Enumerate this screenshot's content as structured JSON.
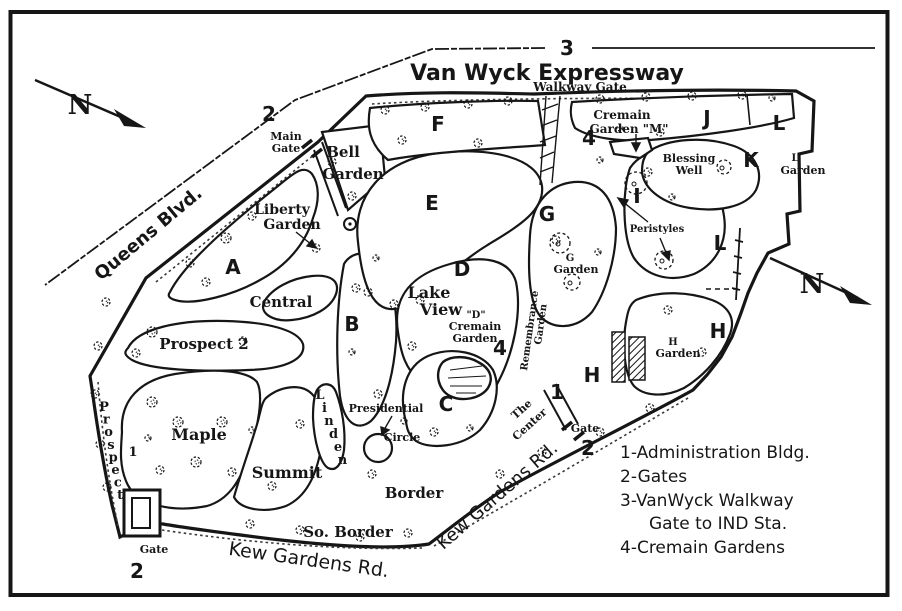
{
  "canvas": {
    "ink": "#161616",
    "bg": "#ffffff"
  },
  "map": {
    "labels": [
      {
        "id": "road-van-wyck-label",
        "t": "Van Wyck Expressway",
        "x": 547,
        "y": 80,
        "s": 22,
        "f": "sa",
        "w": 700
      },
      {
        "id": "marker-3-van-wyck",
        "t": "3",
        "x": 567,
        "y": 55,
        "s": 20,
        "f": "sa",
        "w": 700
      },
      {
        "id": "walkway-gate-label",
        "t": "Walkway Gate",
        "x": 580,
        "y": 91,
        "s": 12,
        "f": "se",
        "w": 700
      },
      {
        "id": "road-queens-blvd-label",
        "t": "Queens Blvd.",
        "x": 152,
        "y": 238,
        "s": 18,
        "f": "sa",
        "w": 700,
        "r": -40
      },
      {
        "id": "compass-n-top-label",
        "t": "N",
        "x": 80,
        "y": 114,
        "s": 27,
        "f": "se",
        "w": 700
      },
      {
        "id": "compass-n-right-label",
        "t": "N",
        "x": 812,
        "y": 293,
        "s": 27,
        "f": "se",
        "w": 700
      },
      {
        "id": "marker-2-main-gate",
        "t": "2",
        "x": 269,
        "y": 121,
        "s": 20,
        "f": "sa",
        "w": 700
      },
      {
        "id": "main-gate-label-line1",
        "t": "Main",
        "x": 286,
        "y": 140,
        "s": 11,
        "f": "se",
        "w": 700
      },
      {
        "id": "main-gate-label-line2",
        "t": "Gate",
        "x": 286,
        "y": 152,
        "s": 11,
        "f": "se",
        "w": 700
      },
      {
        "id": "bell-garden-label-line1",
        "t": "Bell",
        "x": 343,
        "y": 157,
        "s": 15,
        "f": "se",
        "w": 700
      },
      {
        "id": "bell-garden-label-line2",
        "t": "Garden",
        "x": 353,
        "y": 179,
        "s": 15,
        "f": "se",
        "w": 700
      },
      {
        "id": "liberty-garden-label-line1",
        "t": "Liberty",
        "x": 282,
        "y": 214,
        "s": 14,
        "f": "se",
        "w": 700
      },
      {
        "id": "liberty-garden-label-line2",
        "t": "Garden",
        "x": 292,
        "y": 229,
        "s": 14,
        "f": "se",
        "w": 700
      },
      {
        "id": "section-a-label",
        "t": "A",
        "x": 233,
        "y": 274,
        "s": 20,
        "f": "sa",
        "w": 700
      },
      {
        "id": "central-label",
        "t": "Central",
        "x": 281,
        "y": 307,
        "s": 15,
        "f": "se",
        "w": 700
      },
      {
        "id": "prospect-2-label",
        "t": "Prospect 2",
        "x": 204,
        "y": 349,
        "s": 15,
        "f": "se",
        "w": 700
      },
      {
        "id": "section-b-label",
        "t": "B",
        "x": 352,
        "y": 331,
        "s": 20,
        "f": "sa",
        "w": 700
      },
      {
        "id": "maple-label",
        "t": "Maple",
        "x": 199,
        "y": 440,
        "s": 16,
        "f": "se",
        "w": 700
      },
      {
        "id": "summit-label",
        "t": "Summit",
        "x": 287,
        "y": 478,
        "s": 16,
        "f": "se",
        "w": 700
      },
      {
        "id": "prospect-1-label",
        "t": "Prospect",
        "type": "v",
        "x": 104,
        "y": 411,
        "dx": 2.3,
        "dy": 12.6,
        "s": 13,
        "f": "se",
        "w": 700
      },
      {
        "id": "marker-1-prospect",
        "t": "1",
        "x": 133,
        "y": 456,
        "s": 13,
        "f": "se",
        "w": 700
      },
      {
        "id": "linden-label",
        "t": "Linden",
        "type": "v",
        "x": 320,
        "y": 399,
        "dx": 4.5,
        "dy": 13,
        "s": 13,
        "f": "se",
        "w": 700
      },
      {
        "id": "presidential-label-line1",
        "t": "Presidential",
        "x": 386,
        "y": 412,
        "s": 11,
        "f": "se",
        "w": 700
      },
      {
        "id": "presidential-label-line2",
        "t": "Circle",
        "x": 402,
        "y": 441,
        "s": 11,
        "f": "se",
        "w": 700
      },
      {
        "id": "border-label",
        "t": "Border",
        "x": 414,
        "y": 498,
        "s": 15,
        "f": "se",
        "w": 700
      },
      {
        "id": "so-border-label",
        "t": "So. Border",
        "x": 348,
        "y": 537,
        "s": 15,
        "f": "se",
        "w": 700
      },
      {
        "id": "road-kew-gardens-south-label",
        "t": "Kew Gardens Rd.",
        "x": 308,
        "y": 566,
        "s": 19,
        "f": "sa",
        "w": 400,
        "r": 8
      },
      {
        "id": "gate-sw-label",
        "t": "Gate",
        "x": 154,
        "y": 553,
        "s": 11,
        "f": "se",
        "w": 700
      },
      {
        "id": "marker-2-sw-gate",
        "t": "2",
        "x": 137,
        "y": 578,
        "s": 20,
        "f": "sa",
        "w": 700
      },
      {
        "id": "section-c-label",
        "t": "C",
        "x": 446,
        "y": 411,
        "s": 20,
        "f": "sa",
        "w": 700
      },
      {
        "id": "section-d-label",
        "t": "D",
        "x": 462,
        "y": 276,
        "s": 20,
        "f": "sa",
        "w": 700
      },
      {
        "id": "lake-view-label-line1",
        "t": "Lake",
        "x": 429,
        "y": 298,
        "s": 16,
        "f": "se",
        "w": 700
      },
      {
        "id": "lake-view-label-line2",
        "t": "View",
        "x": 441,
        "y": 315,
        "s": 16,
        "f": "se",
        "w": 700
      },
      {
        "id": "d-cremain-label-line1",
        "t": "\"D\"",
        "x": 476,
        "y": 318,
        "s": 10,
        "f": "se",
        "w": 700
      },
      {
        "id": "d-cremain-label-line2",
        "t": "Cremain",
        "x": 475,
        "y": 330,
        "s": 11,
        "f": "se",
        "w": 700
      },
      {
        "id": "d-cremain-label-line3",
        "t": "Garden",
        "x": 475,
        "y": 342,
        "s": 11,
        "f": "se",
        "w": 700
      },
      {
        "id": "marker-4-d-cremain",
        "t": "4",
        "x": 500,
        "y": 355,
        "s": 20,
        "f": "sa",
        "w": 700
      },
      {
        "id": "remembrance-label-line1",
        "t": "Remembrance",
        "x": 527,
        "y": 371,
        "s": 10,
        "f": "se",
        "w": 700,
        "r": -82,
        "a": "start"
      },
      {
        "id": "remembrance-label-line2",
        "t": "Garden",
        "x": 541,
        "y": 345,
        "s": 10,
        "f": "se",
        "w": 700,
        "r": -82,
        "a": "start"
      },
      {
        "id": "section-e-label",
        "t": "E",
        "x": 432,
        "y": 210,
        "s": 20,
        "f": "sa",
        "w": 700
      },
      {
        "id": "section-f-label",
        "t": "F",
        "x": 438,
        "y": 131,
        "s": 20,
        "f": "sa",
        "w": 700
      },
      {
        "id": "cremain-m-label-line1",
        "t": "Cremain",
        "x": 622,
        "y": 119,
        "s": 12,
        "f": "se",
        "w": 700
      },
      {
        "id": "cremain-m-label-line2",
        "t": "Garden \"M\"",
        "x": 629,
        "y": 133,
        "s": 12,
        "f": "se",
        "w": 700
      },
      {
        "id": "marker-4-cremain-m",
        "t": "4",
        "x": 589,
        "y": 145,
        "s": 20,
        "f": "sa",
        "w": 700
      },
      {
        "id": "section-j-label",
        "t": "J",
        "x": 707,
        "y": 125,
        "s": 20,
        "f": "sa",
        "w": 700
      },
      {
        "id": "section-l-ne-label",
        "t": "L",
        "x": 779,
        "y": 130,
        "s": 20,
        "f": "sa",
        "w": 700
      },
      {
        "id": "section-k-label",
        "t": "K",
        "x": 751,
        "y": 167,
        "s": 20,
        "f": "sa",
        "w": 700
      },
      {
        "id": "blessing-well-label-line1",
        "t": "Blessing",
        "x": 689,
        "y": 162,
        "s": 11,
        "f": "se",
        "w": 700
      },
      {
        "id": "blessing-well-label-line2",
        "t": "Well",
        "x": 689,
        "y": 174,
        "s": 11,
        "f": "se",
        "w": 700
      },
      {
        "id": "l-garden-label-line1",
        "t": "L",
        "x": 795,
        "y": 161,
        "s": 10,
        "f": "se",
        "w": 700
      },
      {
        "id": "l-garden-label-line2",
        "t": "Garden",
        "x": 803,
        "y": 174,
        "s": 11,
        "f": "se",
        "w": 700
      },
      {
        "id": "section-i-label",
        "t": "I",
        "x": 637,
        "y": 203,
        "s": 20,
        "f": "sa",
        "w": 700
      },
      {
        "id": "peristyles-label",
        "t": "Peristyles",
        "x": 657,
        "y": 232,
        "s": 10,
        "f": "se",
        "w": 700
      },
      {
        "id": "section-g-label",
        "t": "G",
        "x": 547,
        "y": 221,
        "s": 20,
        "f": "sa",
        "w": 700
      },
      {
        "id": "g-garden-label-line1",
        "t": "G",
        "x": 570,
        "y": 261,
        "s": 10,
        "f": "se",
        "w": 700
      },
      {
        "id": "g-garden-label-line2",
        "t": "Garden",
        "x": 576,
        "y": 273,
        "s": 11,
        "f": "se",
        "w": 700
      },
      {
        "id": "section-l-mid-label",
        "t": "L",
        "x": 720,
        "y": 250,
        "s": 20,
        "f": "sa",
        "w": 700
      },
      {
        "id": "section-h-se-label",
        "t": "H",
        "x": 718,
        "y": 338,
        "s": 20,
        "f": "sa",
        "w": 700
      },
      {
        "id": "h-garden-label-line1",
        "t": "H",
        "x": 673,
        "y": 345,
        "s": 10,
        "f": "se",
        "w": 700
      },
      {
        "id": "h-garden-label-line2",
        "t": "Garden",
        "x": 678,
        "y": 357,
        "s": 11,
        "f": "se",
        "w": 700
      },
      {
        "id": "section-h-w-label",
        "t": "H",
        "x": 592,
        "y": 382,
        "s": 20,
        "f": "sa",
        "w": 700
      },
      {
        "id": "marker-1-admin",
        "t": "1",
        "x": 557,
        "y": 399,
        "s": 20,
        "f": "sa",
        "w": 700
      },
      {
        "id": "the-center-label-line1",
        "t": "The",
        "x": 524,
        "y": 412,
        "s": 11,
        "f": "se",
        "w": 700,
        "r": -42
      },
      {
        "id": "the-center-label-line2",
        "t": "Center",
        "x": 532,
        "y": 427,
        "s": 11,
        "f": "se",
        "w": 700,
        "r": -42
      },
      {
        "id": "gate-e-label",
        "t": "Gate",
        "x": 585,
        "y": 432,
        "s": 11,
        "f": "se",
        "w": 700
      },
      {
        "id": "marker-2-e-gate",
        "t": "2",
        "x": 588,
        "y": 455,
        "s": 20,
        "f": "sa",
        "w": 700
      },
      {
        "id": "road-kew-gardens-east-label",
        "t": "Kew Gardens Rd.",
        "x": 501,
        "y": 500,
        "s": 18,
        "f": "sa",
        "w": 400,
        "r": -41
      },
      {
        "id": "legend-line-1",
        "t": "1-Administration Bldg.",
        "x": 620,
        "y": 458,
        "s": 17,
        "f": "sa",
        "w": 400,
        "a": "start"
      },
      {
        "id": "legend-line-2",
        "t": "2-Gates",
        "x": 620,
        "y": 482,
        "s": 17,
        "f": "sa",
        "w": 400,
        "a": "start"
      },
      {
        "id": "legend-line-3",
        "t": "3-VanWyck Walkway",
        "x": 620,
        "y": 506,
        "s": 17,
        "f": "sa",
        "w": 400,
        "a": "start"
      },
      {
        "id": "legend-line-4",
        "t": "Gate to IND Sta.",
        "x": 649,
        "y": 529,
        "s": 17,
        "f": "sa",
        "w": 400,
        "a": "start"
      },
      {
        "id": "legend-line-5",
        "t": "4-Cremain Gardens",
        "x": 620,
        "y": 553,
        "s": 17,
        "f": "sa",
        "w": 400,
        "a": "start"
      }
    ],
    "trees": [
      [
        385,
        110,
        4
      ],
      [
        425,
        107,
        4
      ],
      [
        468,
        104,
        4
      ],
      [
        508,
        101,
        4
      ],
      [
        600,
        99,
        4
      ],
      [
        646,
        97,
        4
      ],
      [
        692,
        96,
        4
      ],
      [
        742,
        95,
        4
      ],
      [
        772,
        98,
        3
      ],
      [
        226,
        238,
        5
      ],
      [
        252,
        216,
        4
      ],
      [
        206,
        282,
        4
      ],
      [
        190,
        263,
        4
      ],
      [
        332,
        162,
        4
      ],
      [
        352,
        196,
        4
      ],
      [
        316,
        248,
        4
      ],
      [
        152,
        332,
        5
      ],
      [
        243,
        341,
        4
      ],
      [
        136,
        353,
        4
      ],
      [
        106,
        302,
        4
      ],
      [
        98,
        346,
        4
      ],
      [
        95,
        394,
        4
      ],
      [
        100,
        444,
        4
      ],
      [
        107,
        487,
        4
      ],
      [
        152,
        402,
        5
      ],
      [
        178,
        422,
        5
      ],
      [
        222,
        422,
        5
      ],
      [
        196,
        462,
        5
      ],
      [
        232,
        472,
        4
      ],
      [
        160,
        470,
        4
      ],
      [
        148,
        438,
        3
      ],
      [
        300,
        424,
        4
      ],
      [
        272,
        486,
        4
      ],
      [
        252,
        430,
        3
      ],
      [
        356,
        288,
        4
      ],
      [
        378,
        394,
        4
      ],
      [
        352,
        352,
        3
      ],
      [
        368,
        292,
        4
      ],
      [
        394,
        304,
        4
      ],
      [
        420,
        300,
        4
      ],
      [
        376,
        258,
        3
      ],
      [
        402,
        140,
        4
      ],
      [
        478,
        143,
        4
      ],
      [
        412,
        346,
        4
      ],
      [
        470,
        428,
        3
      ],
      [
        434,
        432,
        4
      ],
      [
        556,
        240,
        4
      ],
      [
        598,
        252,
        3
      ],
      [
        648,
        172,
        4
      ],
      [
        672,
        197,
        3
      ],
      [
        660,
        132,
        4
      ],
      [
        620,
        128,
        3
      ],
      [
        600,
        160,
        3
      ],
      [
        702,
        352,
        4
      ],
      [
        668,
        310,
        4
      ],
      [
        500,
        474,
        4
      ],
      [
        542,
        452,
        4
      ],
      [
        600,
        432,
        4
      ],
      [
        650,
        408,
        4
      ],
      [
        250,
        524,
        4
      ],
      [
        300,
        530,
        4
      ],
      [
        360,
        537,
        4
      ],
      [
        408,
        533,
        4
      ],
      [
        372,
        474,
        4
      ],
      [
        404,
        421,
        3
      ]
    ],
    "garden_circles": [
      [
        560,
        243,
        10
      ],
      [
        572,
        282,
        8
      ],
      [
        636,
        183,
        11
      ],
      [
        664,
        260,
        9
      ],
      [
        724,
        167,
        7
      ]
    ]
  }
}
